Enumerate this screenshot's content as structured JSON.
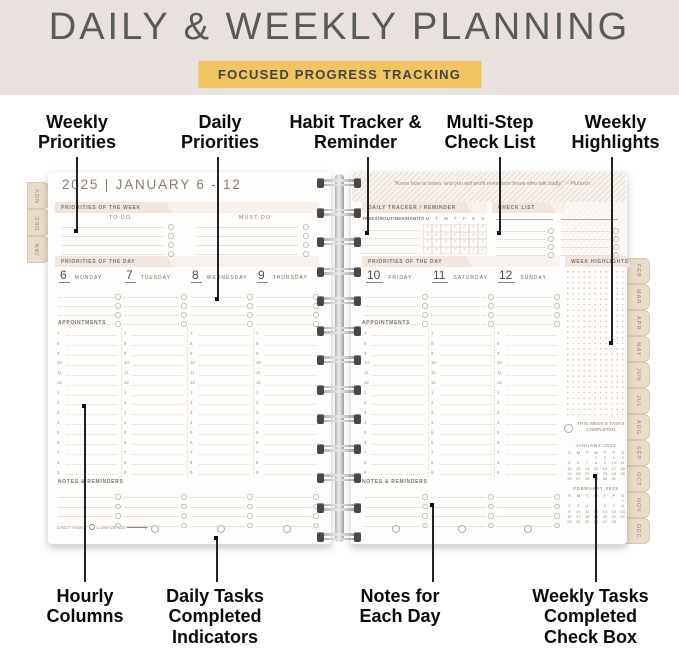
{
  "header": {
    "title": "DAILY & WEEKLY PLANNING",
    "badge": "FOCUSED PROGRESS TRACKING"
  },
  "callouts": {
    "top": [
      "Weekly Priorities",
      "Daily Priorities",
      "Habit Tracker & Reminder",
      "Multi-Step Check List",
      "Weekly Highlights"
    ],
    "bottom": [
      "Hourly Columns",
      "Daily Tasks Completed Indicators",
      "Notes for Each Day",
      "Weekly Tasks Completed Check Box"
    ]
  },
  "planner": {
    "left_tabs": [
      "NOV",
      "DEC",
      "JAN"
    ],
    "right_tabs": [
      "FEB",
      "MAR",
      "APR",
      "MAY",
      "JUN",
      "JUL",
      "AUG",
      "SEP",
      "OCT",
      "NOV",
      "DEC"
    ],
    "week_header": "2025 | JANUARY 6 - 12",
    "quote": "\"Know how to listen, and you will profit even from those who talk badly.\" ~ Plutarch",
    "labels": {
      "priorities_of_week": "PRIORITIES OF THE WEEK",
      "to_do": "TO DO",
      "must_do": "MUST DO",
      "priorities_of_day": "PRIORITIES OF THE DAY",
      "appointments": "APPOINTMENTS",
      "notes_reminders": "NOTES & REMINDERS",
      "daily_tracker": "DAILY TRACKER / REMINDER",
      "tasks_routines": "TASKS/ROUTINES/HABITS",
      "check_list": "CHECK LIST",
      "week_highlights": "WEEK HIGHLIGHTS",
      "daily_tasks": "DAILY TASKS",
      "completed": "COMPLETED",
      "weekly_completed": "THIS WEEK'S TASKS COMPLETED"
    },
    "check_glyph": "✓",
    "tracker_day_letters": [
      "M",
      "T",
      "W",
      "T",
      "F",
      "S",
      "S"
    ],
    "left_days": [
      {
        "num": "6",
        "name": "MONDAY"
      },
      {
        "num": "7",
        "name": "TUESDAY"
      },
      {
        "num": "8",
        "name": "WEDNESDAY"
      },
      {
        "num": "9",
        "name": "THURSDAY"
      }
    ],
    "right_days": [
      {
        "num": "10",
        "name": "FRIDAY"
      },
      {
        "num": "11",
        "name": "SATURDAY"
      },
      {
        "num": "12",
        "name": "SUNDAY"
      }
    ],
    "hours": [
      "7",
      "8",
      "9",
      "10",
      "11",
      "12",
      "1",
      "2",
      "3",
      "4",
      "5",
      "6",
      "7",
      "8",
      "9"
    ],
    "mini_calendars": [
      {
        "title": "JANUARY 2025",
        "dow": [
          "S",
          "M",
          "T",
          "W",
          "T",
          "F",
          "S"
        ],
        "weeks": [
          [
            "",
            "",
            "",
            "1",
            "2",
            "3",
            "4"
          ],
          [
            "5",
            "6",
            "7",
            "8",
            "9",
            "10",
            "11"
          ],
          [
            "12",
            "13",
            "14",
            "15",
            "16",
            "17",
            "18"
          ],
          [
            "19",
            "20",
            "21",
            "22",
            "23",
            "24",
            "25"
          ],
          [
            "26",
            "27",
            "28",
            "29",
            "30",
            "31",
            ""
          ]
        ]
      },
      {
        "title": "FEBRUARY 2025",
        "dow": [
          "S",
          "M",
          "T",
          "W",
          "T",
          "F",
          "S"
        ],
        "weeks": [
          [
            "",
            "",
            "",
            "",
            "",
            "",
            "1"
          ],
          [
            "2",
            "3",
            "4",
            "5",
            "6",
            "7",
            "8"
          ],
          [
            "9",
            "10",
            "11",
            "12",
            "13",
            "14",
            "15"
          ],
          [
            "16",
            "17",
            "18",
            "19",
            "20",
            "21",
            "22"
          ],
          [
            "23",
            "24",
            "25",
            "26",
            "27",
            "28",
            ""
          ]
        ]
      }
    ],
    "colors": {
      "banner_bg": "#E9E1DD",
      "badge_bg": "#EFC461",
      "ribbon": "#F1E5DE",
      "tab": "#EADCCA",
      "callout_line": "#222222"
    }
  }
}
